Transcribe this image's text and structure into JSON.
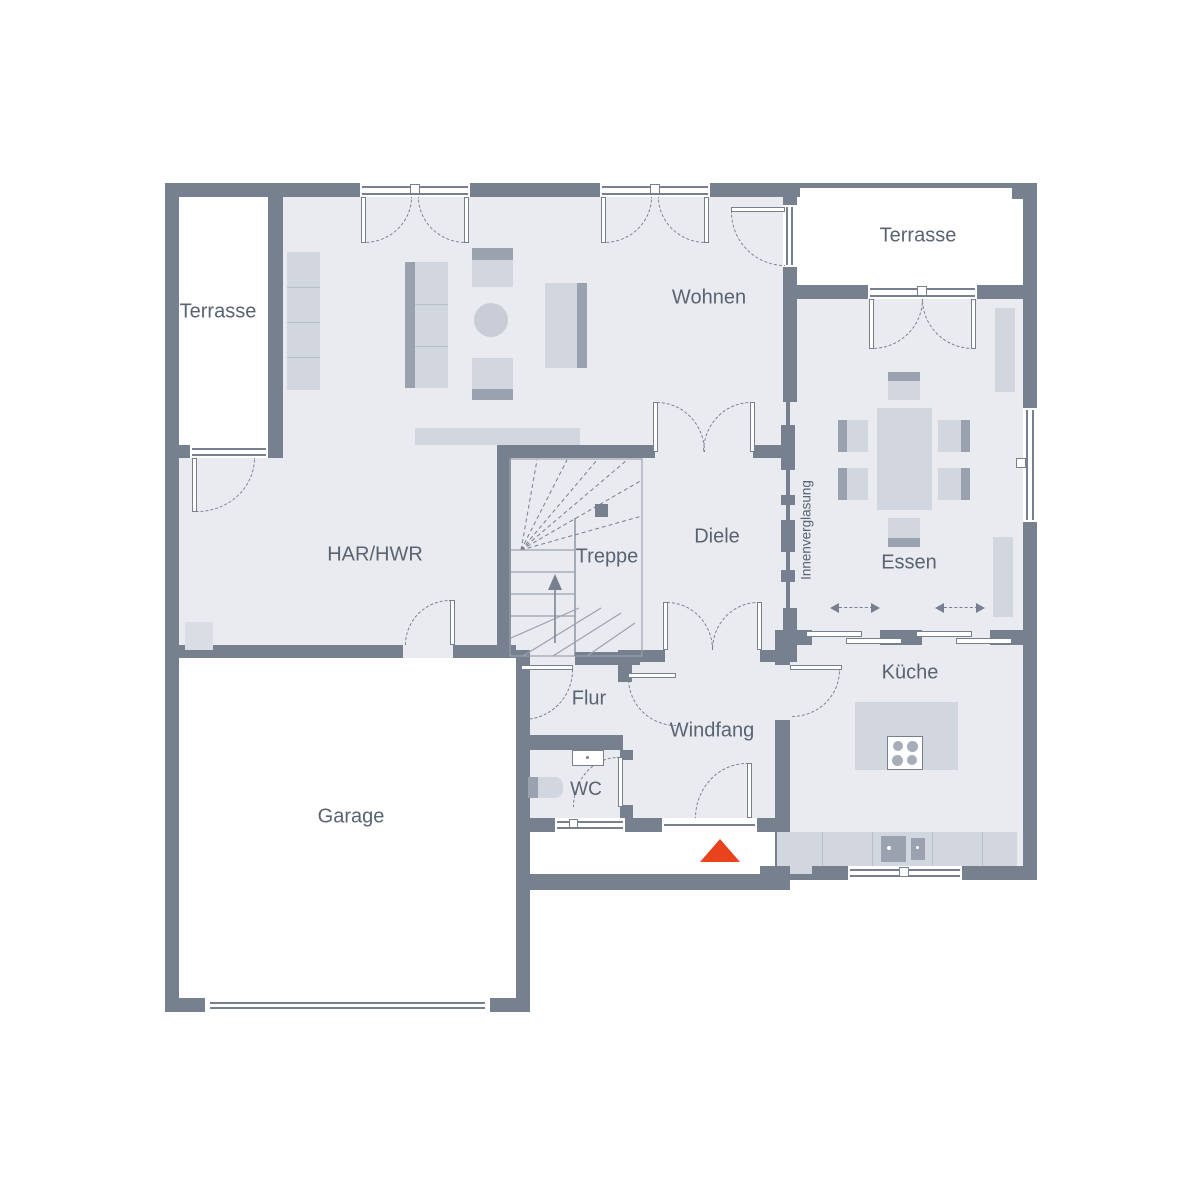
{
  "title": "Erdgeschoss Grundriss",
  "colors": {
    "wall": "#76808F",
    "floor": "#E9EBF0",
    "furniture": "#D2D7DF",
    "furniture_dark": "#9AA2B0",
    "accent": "#E8431C",
    "text": "#5A6372",
    "outside": "#FFFFFF"
  },
  "rooms": [
    {
      "key": "terrasse-left",
      "label": "Terrasse"
    },
    {
      "key": "terrasse-right",
      "label": "Terrasse"
    },
    {
      "key": "wohnen",
      "label": "Wohnen"
    },
    {
      "key": "har-hwr",
      "label": "HAR/HWR"
    },
    {
      "key": "treppe",
      "label": "Treppe"
    },
    {
      "key": "diele",
      "label": "Diele"
    },
    {
      "key": "essen",
      "label": "Essen"
    },
    {
      "key": "kueche",
      "label": "Küche"
    },
    {
      "key": "flur",
      "label": "Flur"
    },
    {
      "key": "windfang",
      "label": "Windfang"
    },
    {
      "key": "wc",
      "label": "WC"
    },
    {
      "key": "garage",
      "label": "Garage"
    }
  ],
  "annotations": {
    "glazing": "Innenverglasung"
  }
}
